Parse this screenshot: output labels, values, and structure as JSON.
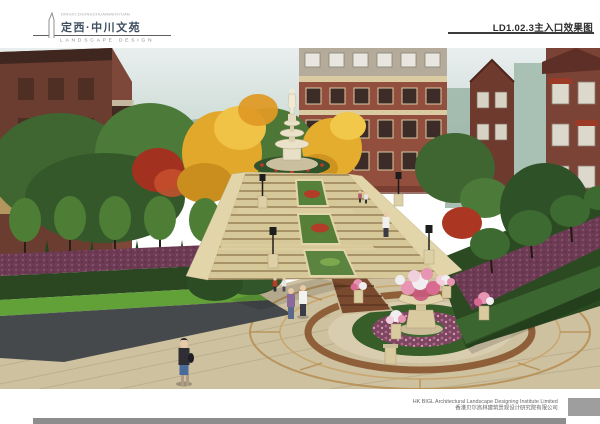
{
  "header": {
    "tagline": "DINGXI·ZHONGCHUANWENYUAN",
    "title": "定西·中川文苑",
    "subtitle": "LANDSCAPE DESIGN",
    "sheet_label": "LD1.02.3主入口效果图"
  },
  "footer": {
    "company_en": "HK BIGL Architectural Landscape Designing Institute Limited",
    "company_zh": "香港贝尔高林建筑景观设计研究院有限公司"
  },
  "palette": {
    "title_text": "#3d4e60",
    "label_text": "#2c2c2c",
    "footer_text": "#666666",
    "footer_block": "#9e9e9e",
    "footer_bar": "#8d8d8d",
    "brick_red": "#94503f",
    "autumn_yellow": "#e2a82c",
    "maple_red": "#a33120",
    "foliage_green": "#4c7a38",
    "stone_beige": "#d8c99e",
    "plaza_paving": "#cdc1a0",
    "purple_shrub": "#6d3c54",
    "flower_pink": "#e795b2"
  }
}
